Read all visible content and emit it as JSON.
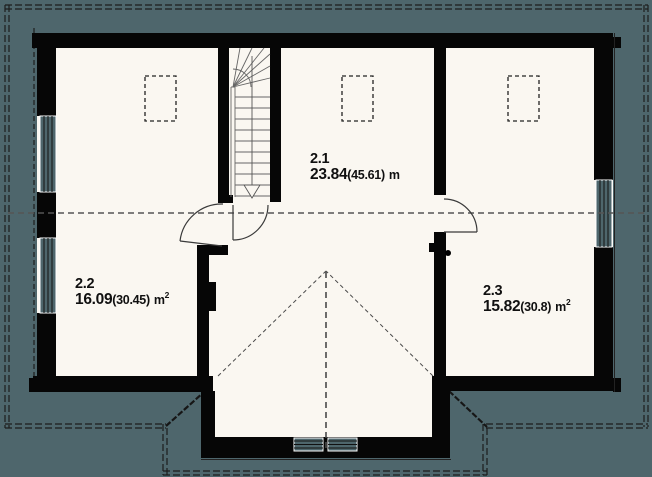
{
  "plan": {
    "type": "architectural-floor-plan-upper-storey",
    "rooms": [
      {
        "number": "2.1",
        "area": "23.84",
        "area_secondary": "(45.61)",
        "unit": "m",
        "unit_sup": ""
      },
      {
        "number": "2.2",
        "area": "16.09",
        "area_secondary": "(30.45)",
        "unit": "m",
        "unit_sup": "2"
      },
      {
        "number": "2.3",
        "area": "15.82",
        "area_secondary": "(30.8)",
        "unit": "m",
        "unit_sup": "2"
      }
    ],
    "colors": {
      "background": "#4e666c",
      "floor": "#faf7f1",
      "wall": "#060606",
      "roof_outline": "#1d1d1d",
      "knee_line": "#555555",
      "stair_line": "#666666",
      "door_line": "#3a3a3a"
    }
  }
}
